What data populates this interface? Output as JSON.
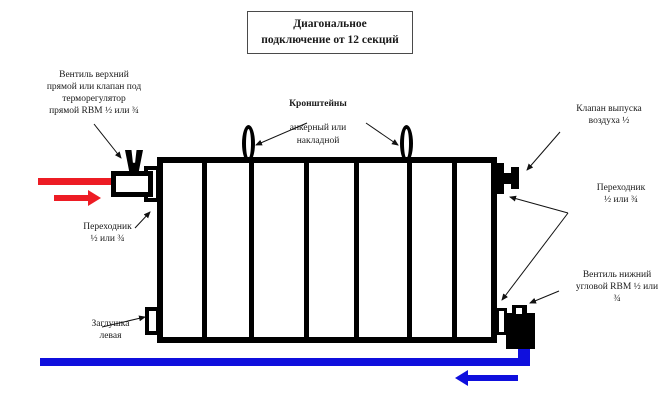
{
  "title": "Диагональное\nподключение от 12 секций",
  "colors": {
    "supply": "#ed1c24",
    "return": "#0f0fdd"
  },
  "diagram": {
    "sections_drawn": 7
  },
  "labels": {
    "valve_top_left": "Вентиль верхний\nпрямой или клапан под\nтерморегулятор\nпрямой RBM ½ или ¾",
    "brackets_title": "Кронштейны",
    "brackets_sub": "анкерный или\nнакладной",
    "air_valve": "Клапан выпуска\nвоздуха ½",
    "adapter_right": "Переходник\n½ или ¾",
    "valve_bottom_right": "Вентиль нижний\nугловой RBM ½ или\n¾",
    "adapter_left": "Переходник\n½ или ¾",
    "plug_left": "Заглушка\nлевая"
  }
}
